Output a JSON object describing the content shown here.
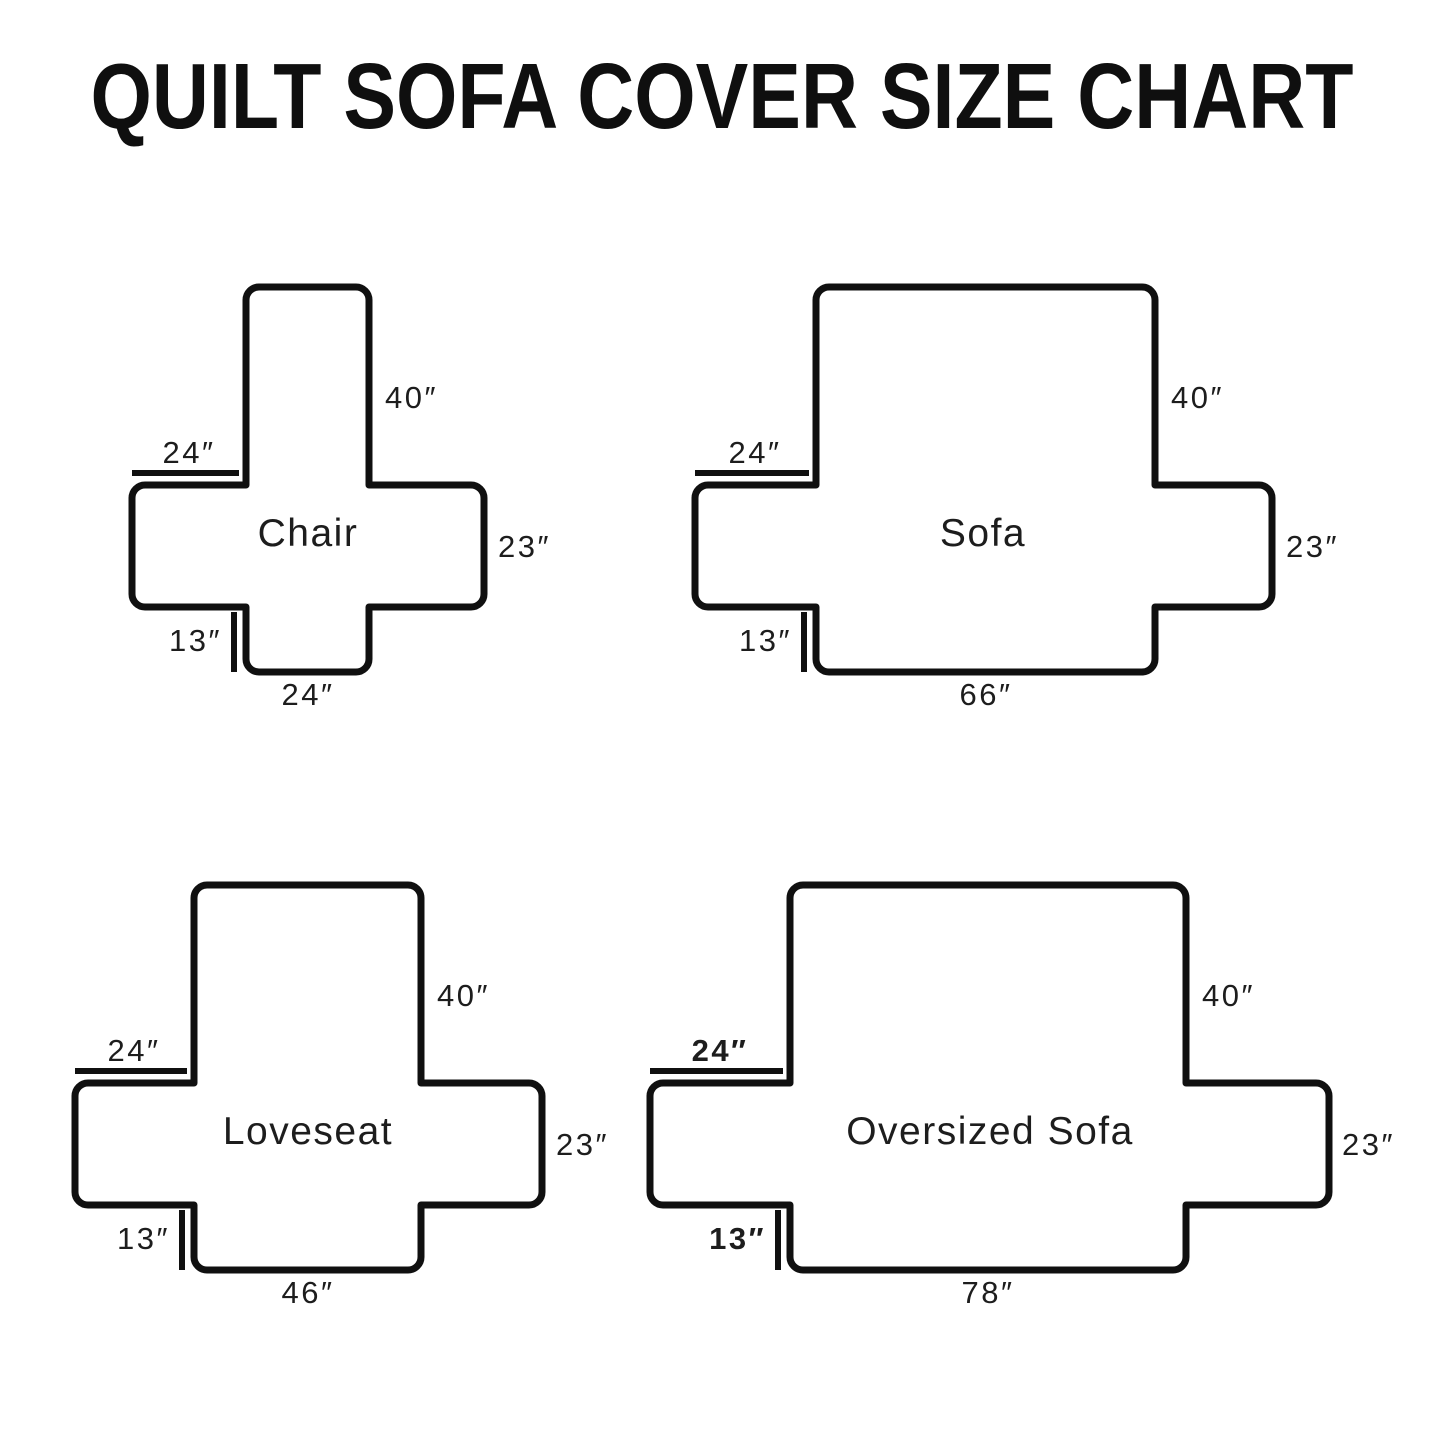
{
  "title": "QUILT SOFA COVER SIZE CHART",
  "colors": {
    "background": "#ffffff",
    "line": "#101010",
    "text": "#1d1d1d"
  },
  "diagrams": [
    {
      "name": "Chair",
      "back_height": "40″",
      "arm_top_width": "24″",
      "side_height": "23″",
      "front_skirt_height": "13″",
      "bottom_width": "24″"
    },
    {
      "name": "Sofa",
      "back_height": "40″",
      "arm_top_width": "24″",
      "side_height": "23″",
      "front_skirt_height": "13″",
      "bottom_width": "66″"
    },
    {
      "name": "Loveseat",
      "back_height": "40″",
      "arm_top_width": "24″",
      "side_height": "23″",
      "front_skirt_height": "13″",
      "bottom_width": "46″"
    },
    {
      "name": "Oversized Sofa",
      "back_height": "40″",
      "arm_top_width": "24″",
      "side_height": "23″",
      "front_skirt_height": "13″",
      "bottom_width": "78″"
    }
  ]
}
